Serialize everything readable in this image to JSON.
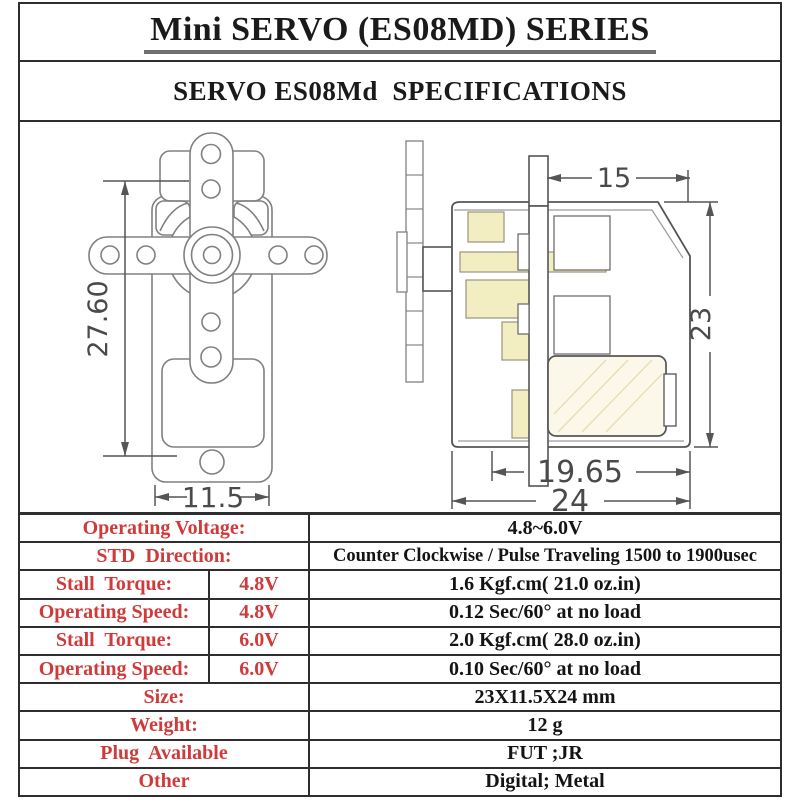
{
  "page": {
    "title": "Mini SERVO (ES08MD) SERIES",
    "subtitle": "SERVO ES08Md  SPECIFICATIONS"
  },
  "drawings": {
    "front_view": {
      "dim_height": "27.60",
      "dim_width": "11.5"
    },
    "side_view": {
      "dim_top": "15",
      "dim_right": "23",
      "dim_bottom_inner": "19.65",
      "dim_bottom_outer": "24"
    }
  },
  "specs": {
    "rows": [
      {
        "label": "Operating Voltage:",
        "value": "4.8~6.0V"
      },
      {
        "label": "STD  Direction:",
        "value": "Counter Clockwise / Pulse Traveling 1500 to 1900usec"
      },
      {
        "label": "Stall  Torque:",
        "voltage": "4.8V",
        "value": "1.6 Kgf.cm( 21.0 oz.in)"
      },
      {
        "label": "Operating Speed:",
        "voltage": "4.8V",
        "value": "0.12 Sec/60° at no load"
      },
      {
        "label": "Stall  Torque:",
        "voltage": "6.0V",
        "value": "2.0 Kgf.cm( 28.0 oz.in)"
      },
      {
        "label": "Operating Speed:",
        "voltage": "6.0V",
        "value": "0.10 Sec/60° at no load"
      },
      {
        "label": "Size:",
        "value": "23X11.5X24 mm"
      },
      {
        "label": "Weight:",
        "value": "12 g"
      },
      {
        "label": "Plug  Available",
        "value": "FUT ;JR"
      },
      {
        "label": "Other",
        "value": "Digital; Metal"
      }
    ]
  },
  "colors": {
    "label_red": "#cf3a3a",
    "table_line": "#2e2e2e",
    "drawing_line_light": "#808080",
    "drawing_line_dark": "#555555",
    "gear_yellow": "#f3eec2",
    "motor_cream": "#fbf8ea"
  }
}
